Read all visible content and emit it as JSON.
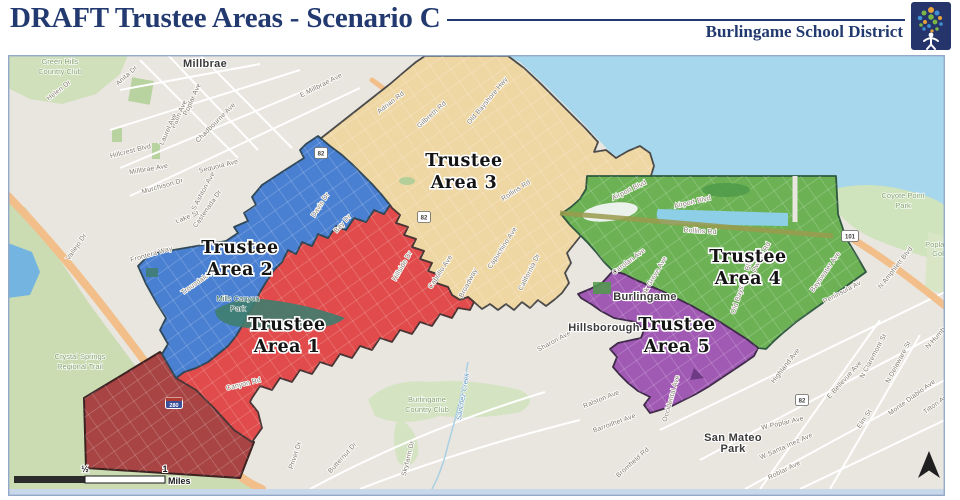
{
  "header": {
    "title": "DRAFT Trustee Areas - Scenario C",
    "district_name": "Burlingame School District"
  },
  "areas": [
    {
      "num": "1",
      "line1": "Trustee",
      "line2": "Area 1",
      "color": "#e14b4b",
      "label_x": 287,
      "label_y": 330
    },
    {
      "num": "2",
      "line1": "Trustee",
      "line2": "Area 2",
      "color": "#4a80d2",
      "label_x": 240,
      "label_y": 253
    },
    {
      "num": "3",
      "line1": "Trustee",
      "line2": "Area 3",
      "color": "#efd7a4",
      "label_x": 464,
      "label_y": 166
    },
    {
      "num": "4",
      "line1": "Trustee",
      "line2": "Area 4",
      "color": "#6cb254",
      "label_x": 748,
      "label_y": 262
    },
    {
      "num": "5",
      "line1": "Trustee",
      "line2": "Area 5",
      "color": "#a15ab4",
      "label_x": 677,
      "label_y": 330
    }
  ],
  "map": {
    "dark_overlay_color": "#a84444",
    "city_labels": [
      {
        "text": "Millbrae",
        "x": 205,
        "y": 67
      },
      {
        "text": "Burlingame",
        "x": 645,
        "y": 300
      },
      {
        "text": "Hillsborough",
        "x": 604,
        "y": 331
      },
      {
        "text": "San Mateo",
        "x": 733,
        "y": 441
      },
      {
        "text": "Park",
        "x": 733,
        "y": 452
      }
    ],
    "park_labels": [
      {
        "text": "Green Hills",
        "x": 60,
        "y": 64
      },
      {
        "text": "Country Club",
        "x": 60,
        "y": 74
      },
      {
        "text": "Crystal Springs",
        "x": 80,
        "y": 359
      },
      {
        "text": "Regional Trail",
        "x": 80,
        "y": 369
      },
      {
        "text": "Burlingame",
        "x": 427,
        "y": 402
      },
      {
        "text": "Country Club",
        "x": 427,
        "y": 412
      },
      {
        "text": "Coyote Point",
        "x": 903,
        "y": 198
      },
      {
        "text": "Park",
        "x": 903,
        "y": 208
      },
      {
        "text": "Poplar",
        "x": 936,
        "y": 247
      },
      {
        "text": "Golf",
        "x": 939,
        "y": 256
      },
      {
        "text": "Mills Canyon",
        "x": 238,
        "y": 301,
        "dark": true
      },
      {
        "text": "Park",
        "x": 238,
        "y": 311,
        "dark": true
      }
    ],
    "street_labels": [
      {
        "text": "Helen Dr",
        "x": 60,
        "y": 92,
        "rot": -38
      },
      {
        "text": "Anita Dr",
        "x": 128,
        "y": 77,
        "rot": -42
      },
      {
        "text": "Poplar Ave",
        "x": 194,
        "y": 100,
        "rot": -66
      },
      {
        "text": "Palm Ave",
        "x": 181,
        "y": 115,
        "rot": -66
      },
      {
        "text": "Laurel Ave",
        "x": 170,
        "y": 130,
        "rot": -66
      },
      {
        "text": "Chadbourne Ave",
        "x": 217,
        "y": 124,
        "rot": -45
      },
      {
        "text": "Hillcrest Blvd",
        "x": 131,
        "y": 153,
        "rot": -14
      },
      {
        "text": "Millbrae Ave",
        "x": 149,
        "y": 171,
        "rot": -10
      },
      {
        "text": "Sequoia Ave",
        "x": 219,
        "y": 168,
        "rot": -14
      },
      {
        "text": "Murchison Dr",
        "x": 163,
        "y": 188,
        "rot": -16
      },
      {
        "text": "S Ashton Ave",
        "x": 205,
        "y": 192,
        "rot": -62
      },
      {
        "text": "Castenada Dr",
        "x": 209,
        "y": 210,
        "rot": -55
      },
      {
        "text": "Lake St",
        "x": 188,
        "y": 219,
        "rot": -22
      },
      {
        "text": "Frontera Way",
        "x": 152,
        "y": 256,
        "rot": -16
      },
      {
        "text": "Trousdale Dr",
        "x": 200,
        "y": 283,
        "rot": -35
      },
      {
        "text": "Davis Dr",
        "x": 322,
        "y": 206,
        "rot": -57
      },
      {
        "text": "Bay Dr",
        "x": 344,
        "y": 225,
        "rot": -48
      },
      {
        "text": "Vallejo Dr",
        "x": 78,
        "y": 248,
        "rot": -55
      },
      {
        "text": "Canyon Rd",
        "x": 244,
        "y": 386,
        "rot": -14
      },
      {
        "text": "Privet Dr",
        "x": 297,
        "y": 456,
        "rot": -72
      },
      {
        "text": "Butternut Dr",
        "x": 344,
        "y": 459,
        "rot": -48
      },
      {
        "text": "Skyfarm Dr",
        "x": 410,
        "y": 459,
        "rot": -76
      },
      {
        "text": "E Millbrae Ave",
        "x": 322,
        "y": 87,
        "rot": -27
      },
      {
        "text": "Adrian Rd",
        "x": 392,
        "y": 104,
        "rot": -38
      },
      {
        "text": "Gilbreth Rd",
        "x": 433,
        "y": 116,
        "rot": -42
      },
      {
        "text": "Old Bayshore Hwy",
        "x": 489,
        "y": 102,
        "rot": -50
      },
      {
        "text": "Rollins Rd",
        "x": 517,
        "y": 192,
        "rot": -33
      },
      {
        "text": "Capuchino Ave",
        "x": 504,
        "y": 249,
        "rot": -57
      },
      {
        "text": "California Dr",
        "x": 531,
        "y": 273,
        "rot": -63
      },
      {
        "text": "Hillside Dr",
        "x": 404,
        "y": 267,
        "rot": -60
      },
      {
        "text": "Cabrillo Ave",
        "x": 442,
        "y": 273,
        "rot": -57
      },
      {
        "text": "Broadway",
        "x": 470,
        "y": 284,
        "rot": -62
      },
      {
        "text": "Airport Blvd",
        "x": 630,
        "y": 192,
        "rot": -26
      },
      {
        "text": "Airport Blvd",
        "x": 693,
        "y": 204,
        "rot": -13
      },
      {
        "text": "Rollins Rd",
        "x": 700,
        "y": 233,
        "rot": 4
      },
      {
        "text": "Carolan Ave",
        "x": 630,
        "y": 263,
        "rot": -37
      },
      {
        "text": "Oak Grove Ave",
        "x": 655,
        "y": 279,
        "rot": -60
      },
      {
        "text": "Dwight Rd",
        "x": 763,
        "y": 258,
        "rot": -62
      },
      {
        "text": "Old Bayshore Blvd",
        "x": 744,
        "y": 286,
        "rot": -72
      },
      {
        "text": "Bayswater Ave",
        "x": 827,
        "y": 273,
        "rot": -55
      },
      {
        "text": "N Amphlett Blvd",
        "x": 897,
        "y": 269,
        "rot": -52
      },
      {
        "text": "Peninsula Av",
        "x": 843,
        "y": 294,
        "rot": -28
      },
      {
        "text": "Sharon Ave",
        "x": 555,
        "y": 343,
        "rot": -28
      },
      {
        "text": "Ralston Ave",
        "x": 602,
        "y": 401,
        "rot": -22
      },
      {
        "text": "Barroilhet Ave",
        "x": 615,
        "y": 425,
        "rot": -20
      },
      {
        "text": "Bromfield Rd",
        "x": 634,
        "y": 464,
        "rot": -42
      },
      {
        "text": "Occidental Ave",
        "x": 673,
        "y": 399,
        "rot": -74
      },
      {
        "text": "Highland Ave",
        "x": 787,
        "y": 367,
        "rot": -52
      },
      {
        "text": "E Bellevue Ave",
        "x": 846,
        "y": 381,
        "rot": -48
      },
      {
        "text": "N Claremont St",
        "x": 875,
        "y": 357,
        "rot": -62
      },
      {
        "text": "N Delaware St",
        "x": 900,
        "y": 363,
        "rot": -62
      },
      {
        "text": "Monte Diablo Ave",
        "x": 913,
        "y": 399,
        "rot": -36
      },
      {
        "text": "Tilton Ave",
        "x": 938,
        "y": 405,
        "rot": -36
      },
      {
        "text": "Elm St",
        "x": 866,
        "y": 420,
        "rot": -56
      },
      {
        "text": "N Humboldt",
        "x": 941,
        "y": 335,
        "rot": -48
      },
      {
        "text": "W Poplar Ave",
        "x": 783,
        "y": 425,
        "rot": -13
      },
      {
        "text": "W Santa Inez Ave",
        "x": 787,
        "y": 448,
        "rot": -24
      },
      {
        "text": "Roblar Ave",
        "x": 785,
        "y": 472,
        "rot": -26
      }
    ],
    "water_labels": [
      {
        "text": "Sanchez Creek",
        "x": 465,
        "y": 397,
        "rot": -80
      }
    ],
    "shields": [
      {
        "label": "82",
        "x": 321,
        "y": 153,
        "kind": "state"
      },
      {
        "label": "82",
        "x": 424,
        "y": 217,
        "kind": "state"
      },
      {
        "label": "82",
        "x": 802,
        "y": 400,
        "kind": "state"
      },
      {
        "label": "101",
        "x": 850,
        "y": 236,
        "kind": "us"
      },
      {
        "label": "280",
        "x": 174,
        "y": 403,
        "kind": "interstate"
      }
    ],
    "scale_bar": {
      "half_label": "½",
      "one_label": "1",
      "unit_label": "Miles"
    }
  }
}
